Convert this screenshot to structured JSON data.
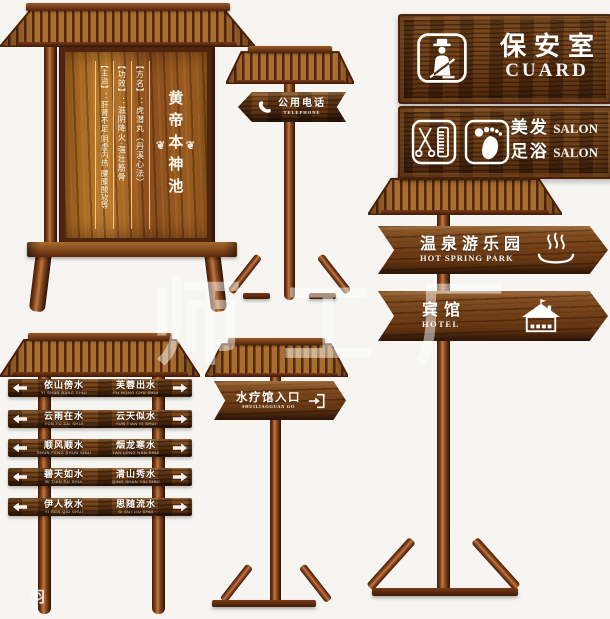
{
  "canvas": {
    "bg": "#f6f5f2"
  },
  "palette": {
    "wood_dark": "#5f3310",
    "wood_mid": "#8a5526",
    "wood_light": "#c07840",
    "frame": "#4a220d",
    "text": "#ffffff"
  },
  "watermark": {
    "text": "师工厂",
    "fragment": "羽"
  },
  "notice_board": {
    "title": "黄帝本神池",
    "ornament": "❦",
    "columns": [
      "【方名】：虎潜丸（丹溪心法）",
      "【功效】：滋阴降火·强壮筋骨",
      "【主治】：肝肾不足·阴虚内热·腰膝酸软等"
    ]
  },
  "phone_sign": {
    "zh": "公用电话",
    "en": "TELEPHONE"
  },
  "guard_plaque": {
    "zh": "保安室",
    "en": "CUARD"
  },
  "salon_plaque": {
    "row1_zh": "美发",
    "row1_en": "SALON",
    "row2_zh": "足浴",
    "row2_en": "SALON"
  },
  "hot_spring_sign": {
    "zh": "温泉游乐园",
    "en": "HOT SPRING PARK"
  },
  "hotel_sign": {
    "zh": "宾馆",
    "en": "HOTEL"
  },
  "spa_sign": {
    "zh": "水疗馆入口",
    "en": "SHUILIAOGUAN GO"
  },
  "slat_sign": {
    "rows": [
      {
        "left": {
          "zh": "依山傍水",
          "en": "YI SHAN BANG SHUI"
        },
        "right": {
          "zh": "芙蓉出水",
          "en": "FU RONG CHU SHUI"
        }
      },
      {
        "left": {
          "zh": "云雨在水",
          "en": "YUN YU ZAI SHUI"
        },
        "right": {
          "zh": "云天似水",
          "en": "YUN TIAN SI SHUI"
        }
      },
      {
        "left": {
          "zh": "顺风顺水",
          "en": "SHUN FENG SHUN SHUI"
        },
        "right": {
          "zh": "烟龙寒水",
          "en": "YAN LONG HAN SHUI"
        }
      },
      {
        "left": {
          "zh": "碧天如水",
          "en": "BI TIAN RU SHUI"
        },
        "right": {
          "zh": "清山秀水",
          "en": "QING SHAN XIU SHUI"
        }
      },
      {
        "left": {
          "zh": "伊人秋水",
          "en": "YI REN QIU SHUI"
        },
        "right": {
          "zh": "思随流水",
          "en": "SI SUI LIU SHUI"
        }
      }
    ]
  }
}
